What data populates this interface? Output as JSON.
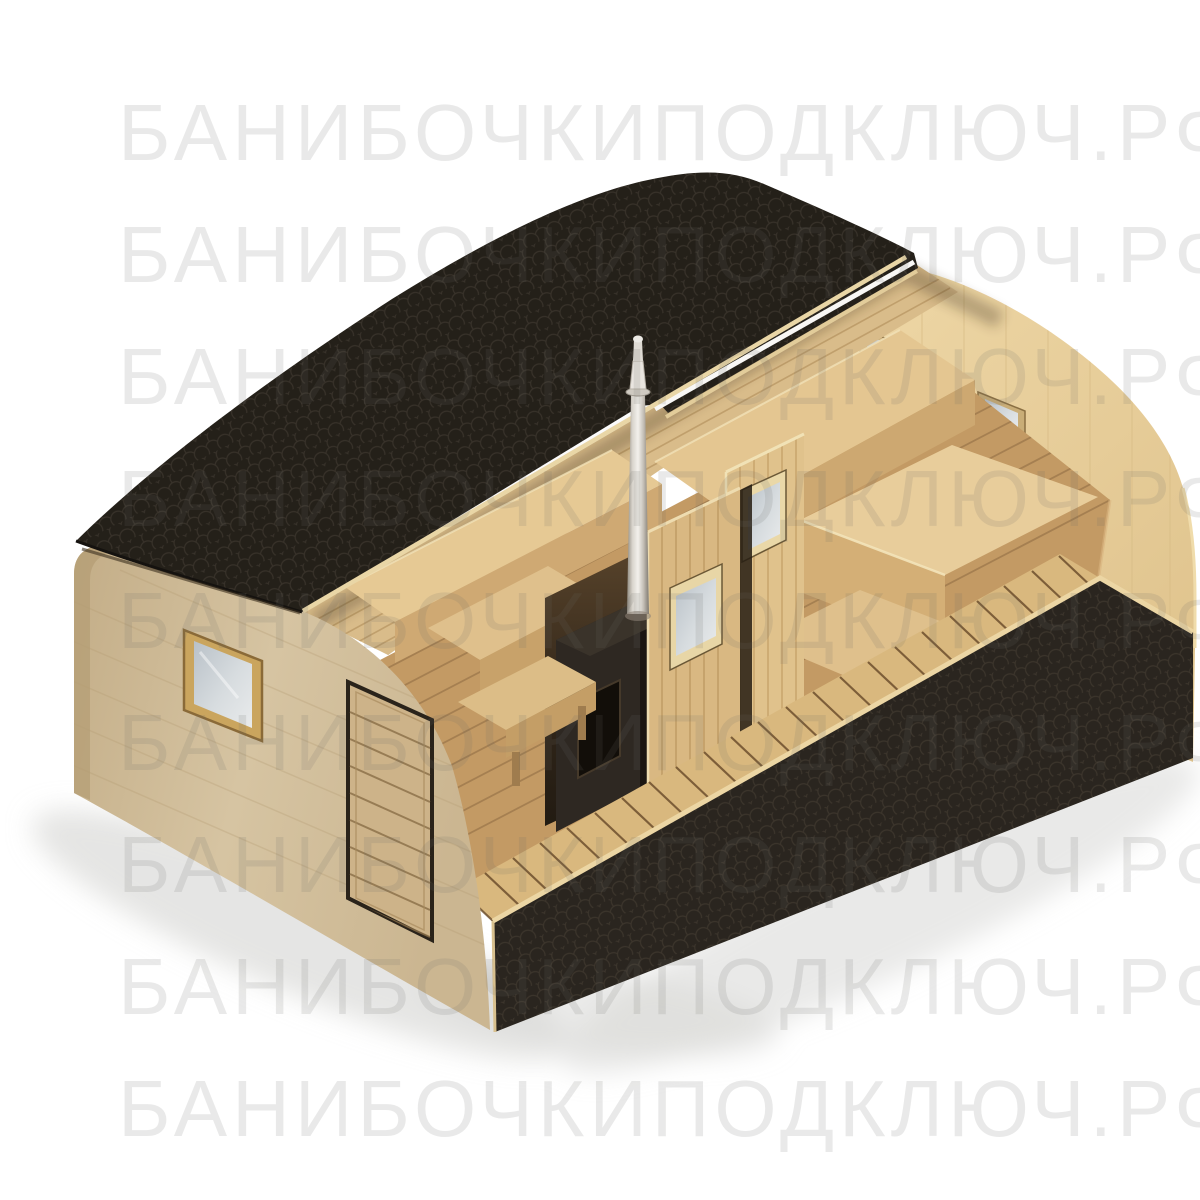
{
  "watermark": {
    "text": "БАНИБОЧКИПОДКЛЮЧ.РФ",
    "row_count": 9,
    "color_hex": "#6c6c68",
    "opacity": 0.14
  },
  "scene": {
    "type": "3d-product-render",
    "subject": "Rectangular quadro barrel sauna, cutaway view showing interior",
    "background_hex": "#ffffff",
    "colors": {
      "roof_shingles": "#211d19",
      "facade_wood": "#d2c09c",
      "interior_wall_wood": "#d9bc8a",
      "floor_wood": "#c39a64",
      "bench_wood": "#e6c994",
      "base_skirt_shingles": "#262220",
      "stove_metal": "#2a241e",
      "chimney_steel": "#d9d5cd",
      "window_glass": "#c5cbd1"
    },
    "elements": {
      "roof_sections": 2,
      "roof_material": "black fish-scale bitumen shingles",
      "facade_windows": 1,
      "facade_doors": 1,
      "end_wall_windows": 2,
      "partition_doors": 2,
      "partition_door_windows": 2,
      "stoves": 1,
      "chimneys": 1,
      "benches": [
        "washroom corner bench",
        "washroom table",
        "washroom stool",
        "steam room upper bench",
        "steam room main bench",
        "steam room step"
      ],
      "base_skirt": "black fish-scale shingle band around base"
    }
  }
}
